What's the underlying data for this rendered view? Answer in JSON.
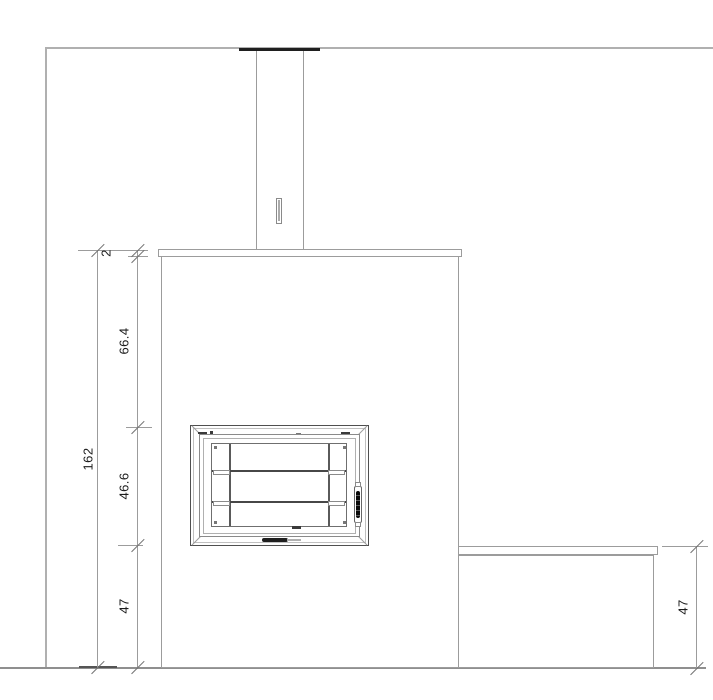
{
  "colors": {
    "background": "#ffffff",
    "wall_line": "#b0b0b0",
    "object_line": "#9c9c9c",
    "dark_detail": "#1f1f1f",
    "dimension_text": "#1c1c1c"
  },
  "dimensions": {
    "cap_thickness": "2",
    "upper_section": "66.4",
    "firebox_door": "46.6",
    "base_section": "47",
    "total_height": "162",
    "bench_height": "47"
  }
}
